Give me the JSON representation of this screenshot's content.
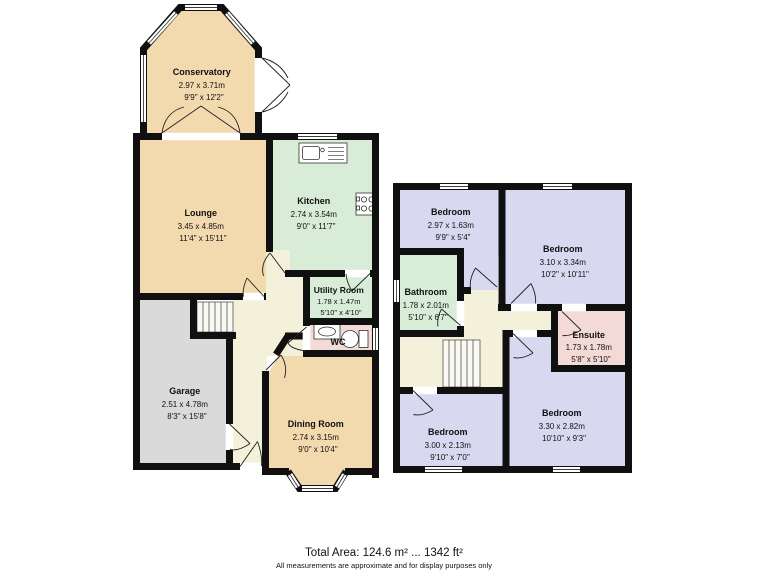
{
  "colors": {
    "wall": "#101010",
    "tan": "#f3d9ae",
    "green": "#d9ecd7",
    "cream": "#f3f1da",
    "gray": "#dadada",
    "lavender": "#d8d8f0",
    "pink": "#f3dad6",
    "stairs": "#fbfaf2"
  },
  "ground_floor": {
    "conservatory": {
      "name": "Conservatory",
      "metric": "2.97 x 3.71m",
      "imperial": "9'9\" x 12'2\""
    },
    "lounge": {
      "name": "Lounge",
      "metric": "3.45 x 4.85m",
      "imperial": "11'4\" x 15'11\""
    },
    "kitchen": {
      "name": "Kitchen",
      "metric": "2.74 x 3.54m",
      "imperial": "9'0\" x 11'7\""
    },
    "utility": {
      "name": "Utility Room",
      "metric": "1.78 x 1.47m",
      "imperial": "5'10\" x 4'10\""
    },
    "wc": {
      "name": "WC"
    },
    "garage": {
      "name": "Garage",
      "metric": "2.51 x 4.78m",
      "imperial": "8'3\" x 15'8\""
    },
    "dining": {
      "name": "Dining Room",
      "metric": "2.74 x 3.15m",
      "imperial": "9'0\" x 10'4\""
    }
  },
  "first_floor": {
    "bedroom1": {
      "name": "Bedroom",
      "metric": "2.97 x 1.63m",
      "imperial": "9'9\" x 5'4\""
    },
    "bedroom2": {
      "name": "Bedroom",
      "metric": "3.10 x 3.34m",
      "imperial": "10'2\" x 10'11\""
    },
    "bathroom": {
      "name": "Bathroom",
      "metric": "1.78 x 2.01m",
      "imperial": "5'10\" x 6'7\""
    },
    "ensuite": {
      "name": "Ensuite",
      "metric": "1.73 x 1.78m",
      "imperial": "5'8\" x 5'10\""
    },
    "bedroom3": {
      "name": "Bedroom",
      "metric": "3.00 x 2.13m",
      "imperial": "9'10\" x 7'0\""
    },
    "bedroom4": {
      "name": "Bedroom",
      "metric": "3.30 x 2.82m",
      "imperial": "10'10\" x 9'3\""
    }
  },
  "footer": {
    "total_area": "Total Area: 124.6 m² ... 1342 ft²",
    "disclaimer": "All measurements are approximate and for display purposes only"
  }
}
